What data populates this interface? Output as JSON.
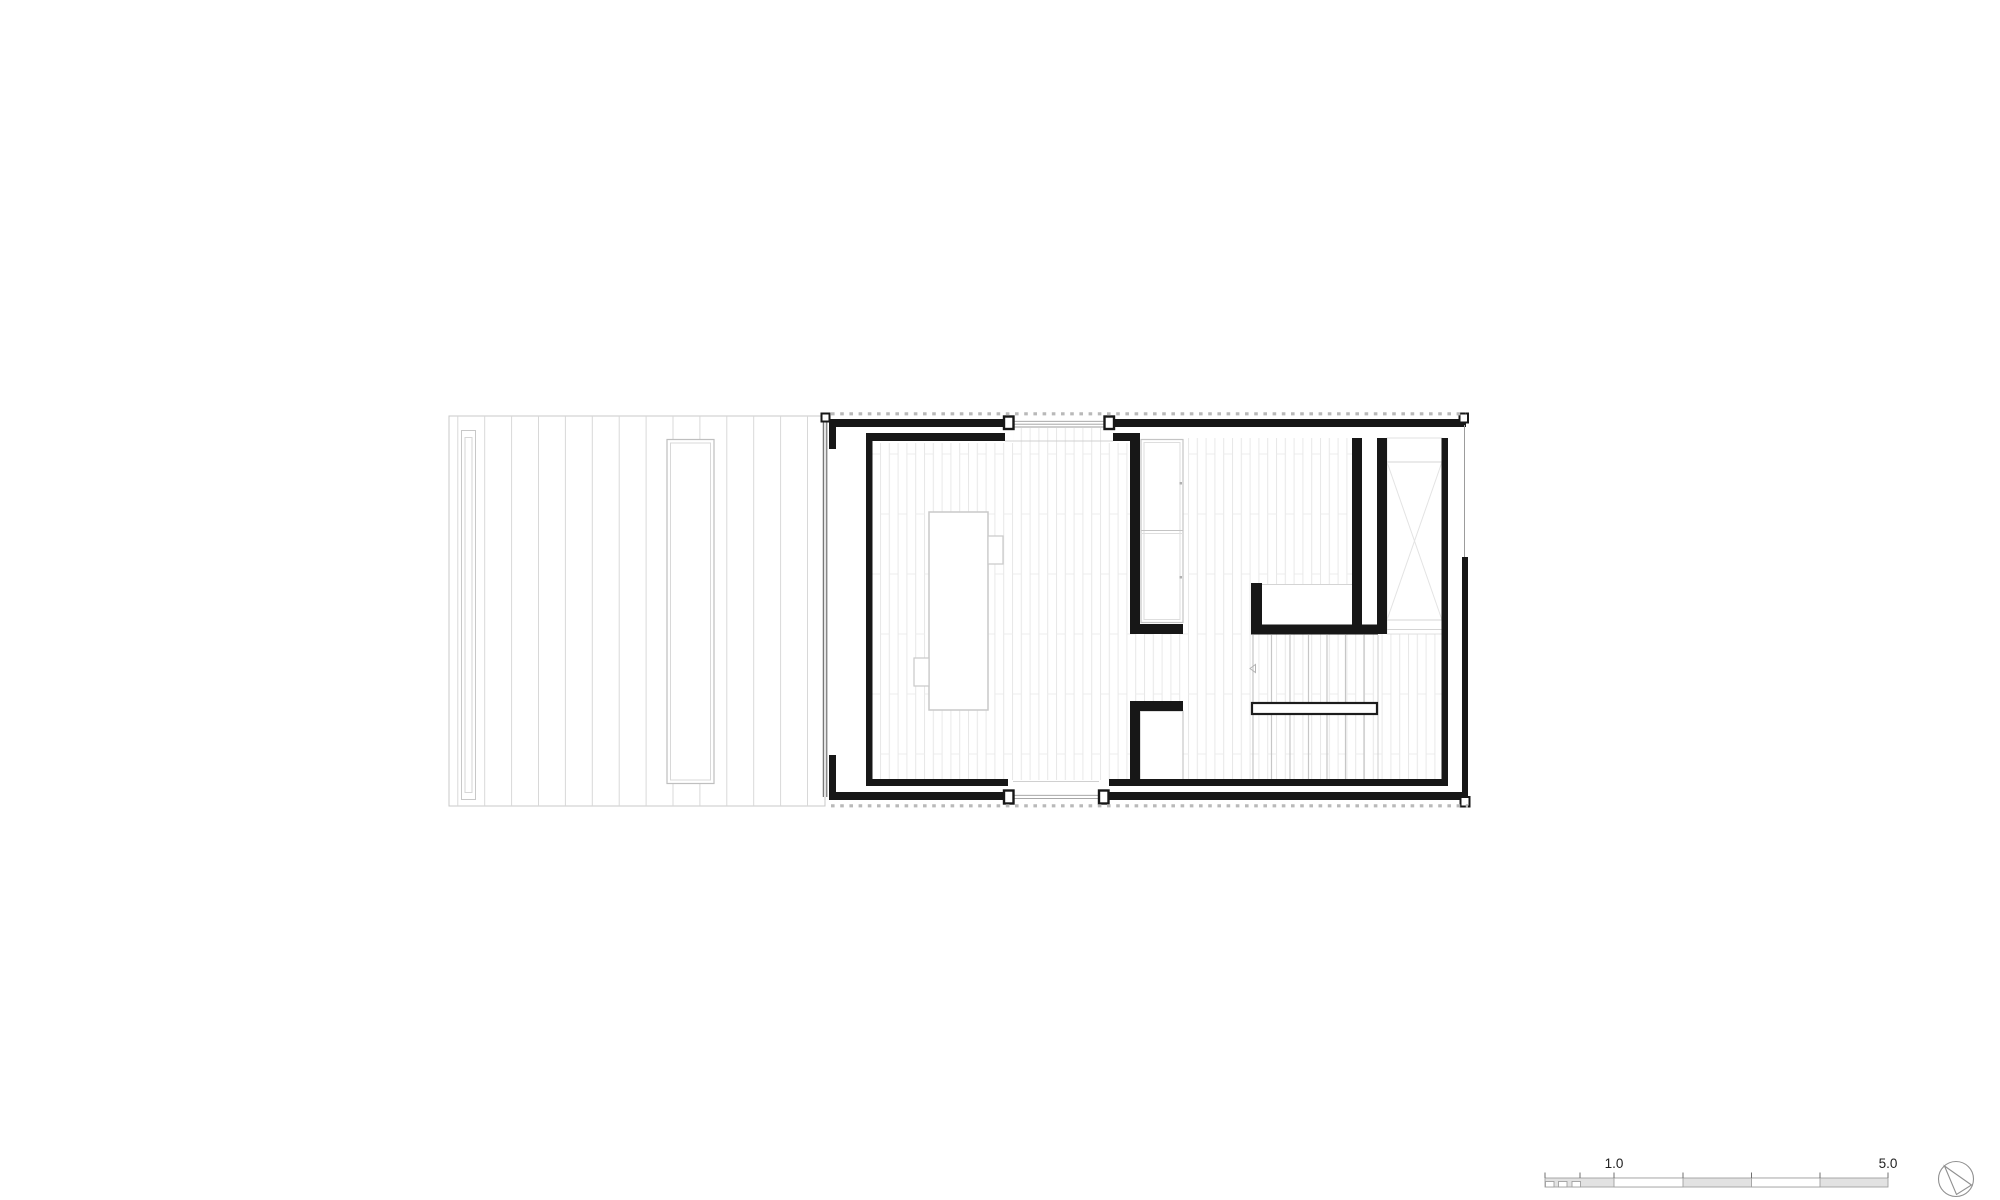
{
  "document": {
    "kind": "architectural floor plan drawing",
    "background": "#ffffff"
  },
  "scale_bar": {
    "label_1": "1.0",
    "label_5": "5.0",
    "bar_fill": "#e2e2e2",
    "bar_outline": "#a0a0a0"
  },
  "icons": {
    "north_arrow": "north-arrow-icon"
  },
  "colors": {
    "wall": "#171717",
    "floor_hatch_line": "#e8e8e8",
    "deck_plank_line": "#d8d8d8",
    "detail_outline": "#c9c9c9",
    "glazing_line": "#9c9c9c",
    "cladding_dash": "#b9b9b9"
  }
}
